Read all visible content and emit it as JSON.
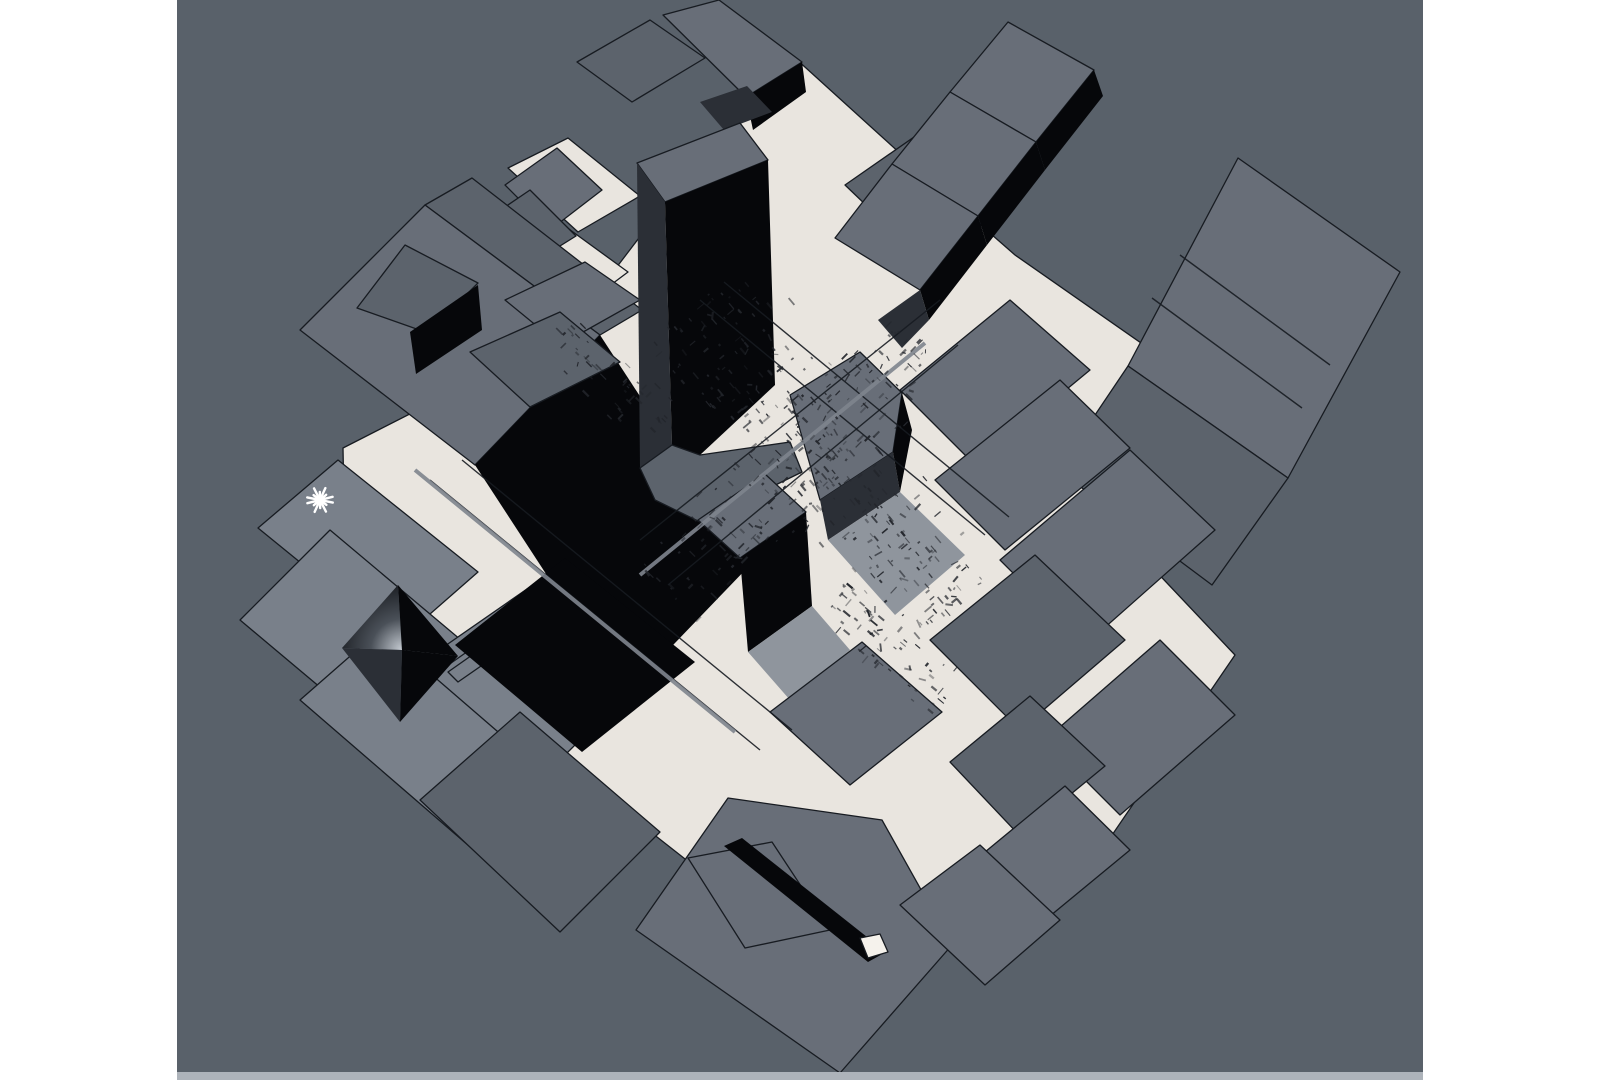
{
  "meta": {
    "description": "Aerial axonometric 3D massing model of a dense city district (Times Square style) shown in a render viewport",
    "view": "perspective top-down, model rotated ~40 degrees",
    "visible_text": "none"
  },
  "canvas": {
    "width": 1599,
    "height": 1080,
    "margin_color": "#ffffff"
  },
  "viewport": {
    "x": 177,
    "y": 0,
    "width": 1246,
    "height": 1080,
    "background": "#59616a",
    "bottom_strip": {
      "x": 177,
      "y": 1072,
      "width": 1246,
      "height": 8,
      "color": "#adb3ba"
    }
  },
  "palette": {
    "bg": "#59616a",
    "roof": "#686e78",
    "roofL": "#79808a",
    "roofD": "#5c636c",
    "side": "#06070a",
    "side2": "#2b2f36",
    "cream": "#e9e5df",
    "creamB": "#f5f2ec",
    "line": "#171b21",
    "shadow": "#8f959d",
    "bar": "#7f858e",
    "noise": "#23262c",
    "marker": "#ffffff"
  },
  "marker": {
    "shape": "asterisk-light-marker",
    "x": 320,
    "y": 500,
    "size": 13,
    "spikes": 7,
    "color": "#ffffff"
  },
  "scene": {
    "gradients": [
      {
        "id": "pyrGrad",
        "type": "radial",
        "cx": 402,
        "cy": 650,
        "r": 78,
        "stops": [
          [
            "0",
            "#c6ccd3"
          ],
          [
            "0.4",
            "#4a5058"
          ],
          [
            "1",
            "#0b0d11"
          ]
        ]
      }
    ],
    "polygons": [
      {
        "name": "ground-plaza",
        "fill": "cream",
        "stroke": "line",
        "points": "795,58 935,185 1015,255 1290,447 1150,565 1235,655 1095,860 995,965 890,880 820,965 610,800 505,690 345,555 343,448 565,335 645,230 705,150"
      },
      {
        "name": "ground-patch-topleft",
        "fill": "cream",
        "stroke": "line",
        "points": "508,168 568,138 640,196 578,232"
      },
      {
        "name": "ground-patch-left",
        "fill": "cream",
        "stroke": "line",
        "points": "515,258 562,224 628,272 580,308"
      },
      {
        "name": "building-far-right-roof",
        "fill": "roof",
        "stroke": "line",
        "points": "1238,158 1400,272 1288,478 1128,366"
      },
      {
        "name": "building-far-right-terrace",
        "fill": "roofD",
        "stroke": "line",
        "points": "1128,366 1288,478 1212,585 1058,470"
      },
      {
        "name": "building-topright-block",
        "fill": "roofD",
        "stroke": "line",
        "points": "845,185 950,112 1020,176 915,252"
      },
      {
        "name": "ziggurat-tier1-roof",
        "fill": "roof",
        "stroke": "line",
        "points": "1008,22 1094,70 1036,142 950,92"
      },
      {
        "name": "ziggurat-tier1-shade",
        "fill": "side",
        "stroke": "none",
        "points": "1094,70 1103,96 1045,170 1036,142"
      },
      {
        "name": "ziggurat-tier2-roof",
        "fill": "roof",
        "stroke": "line",
        "points": "950,92 1036,142 978,216 892,164"
      },
      {
        "name": "ziggurat-tier2-shade",
        "fill": "side",
        "stroke": "none",
        "points": "1036,142 1045,170 987,245 978,216"
      },
      {
        "name": "ziggurat-tier3-roof",
        "fill": "roof",
        "stroke": "line",
        "points": "892,164 978,216 920,290 835,238"
      },
      {
        "name": "ziggurat-tier3-shade",
        "fill": "side",
        "stroke": "none",
        "points": "978,216 987,245 929,320 920,290"
      },
      {
        "name": "ziggurat-base-shade",
        "fill": "side2",
        "stroke": "none",
        "points": "920,290 929,320 902,348 878,320"
      },
      {
        "name": "topcluster-bar-roof",
        "fill": "roofD",
        "stroke": "line",
        "points": "577,62 650,20 705,58 632,102"
      },
      {
        "name": "topcluster-box-roof",
        "fill": "roof",
        "stroke": "line",
        "points": "663,15 719,0 802,62 746,97"
      },
      {
        "name": "topcluster-box-side",
        "fill": "side",
        "stroke": "none",
        "points": "746,97 802,62 806,92 753,130"
      },
      {
        "name": "topcluster-shadow",
        "fill": "side2",
        "stroke": "none",
        "points": "700,102 747,86 772,112 724,130"
      },
      {
        "name": "topleft-small-roof-1",
        "fill": "roof",
        "stroke": "line",
        "points": "505,185 557,148 602,190 550,230"
      },
      {
        "name": "topleft-small-roof-2",
        "fill": "roofD",
        "stroke": "line",
        "points": "468,232 530,190 576,236 515,274"
      },
      {
        "name": "bigslab-terrace",
        "fill": "roofD",
        "stroke": "line",
        "points": "425,205 472,178 642,310 600,335"
      },
      {
        "name": "bigslab-roof",
        "fill": "roof",
        "stroke": "line",
        "points": "300,330 425,205 600,335 475,465"
      },
      {
        "name": "bigslab-penthouse-roof",
        "fill": "roofD",
        "stroke": "line",
        "points": "405,245 478,283 428,333 357,308"
      },
      {
        "name": "bigslab-penthouse-side",
        "fill": "side",
        "stroke": "none",
        "points": "410,332 478,285 482,330 416,374"
      },
      {
        "name": "bigslab-black-face",
        "fill": "side",
        "stroke": "none",
        "points": "475,465 600,335 750,565 625,695"
      },
      {
        "name": "midleft-block-1",
        "fill": "roof",
        "stroke": "line",
        "points": "505,300 585,262 640,300 560,345"
      },
      {
        "name": "midleft-block-2",
        "fill": "roofD",
        "stroke": "line",
        "points": "470,352 560,312 620,362 530,407"
      },
      {
        "name": "tower-roof",
        "fill": "roof",
        "stroke": "line",
        "points": "637,163 740,123 768,160 665,202"
      },
      {
        "name": "tower-west-face",
        "fill": "side2",
        "stroke": "none",
        "points": "637,163 665,202 672,445 640,468"
      },
      {
        "name": "tower-front-face",
        "fill": "side",
        "stroke": "none",
        "points": "665,202 768,160 775,385 700,455 672,445"
      },
      {
        "name": "tower-base-podium",
        "fill": "roofD",
        "stroke": "line",
        "points": "640,468 672,445 700,455 790,442 802,472 700,522 655,500"
      },
      {
        "name": "district-block-0",
        "fill": "roof",
        "stroke": "line",
        "points": "900,390 1010,300 1090,370 975,465"
      },
      {
        "name": "district-block-1",
        "fill": "roof",
        "stroke": "line",
        "points": "935,480 1060,380 1130,448 1005,550"
      },
      {
        "name": "district-block-2",
        "fill": "roof",
        "stroke": "line",
        "points": "1000,560 1130,450 1215,530 1085,645"
      },
      {
        "name": "district-block-3",
        "fill": "roofD",
        "stroke": "line",
        "points": "930,640 1035,555 1125,640 1020,730"
      },
      {
        "name": "district-block-4",
        "fill": "roof",
        "stroke": "line",
        "points": "1045,740 1160,640 1235,715 1120,815"
      },
      {
        "name": "district-block-5",
        "fill": "roofD",
        "stroke": "line",
        "points": "950,762 1030,696 1105,766 1020,836"
      },
      {
        "name": "district-block-6",
        "fill": "roof",
        "stroke": "line",
        "points": "985,852 1065,786 1130,850 1050,916"
      },
      {
        "name": "center-tower-roof",
        "fill": "roof",
        "stroke": "line",
        "points": "790,395 860,352 902,393 893,452 820,500"
      },
      {
        "name": "center-tower-side",
        "fill": "side2",
        "stroke": "none",
        "points": "820,500 893,452 900,492 828,540"
      },
      {
        "name": "center-tower-dark-side",
        "fill": "side",
        "stroke": "none",
        "points": "893,452 902,393 912,430 900,492"
      },
      {
        "name": "center-tower-shadow",
        "fill": "shadow",
        "stroke": "none",
        "points": "828,540 900,492 965,555 895,615"
      },
      {
        "name": "small-tower-roof",
        "fill": "roof",
        "stroke": "line",
        "points": "698,520 765,474 806,512 740,558"
      },
      {
        "name": "small-tower-side",
        "fill": "side",
        "stroke": "none",
        "points": "740,558 806,512 812,606 748,652"
      },
      {
        "name": "small-tower-shadow",
        "fill": "shadow",
        "stroke": "none",
        "points": "748,652 812,606 850,650 790,700"
      },
      {
        "name": "center-bottom-block",
        "fill": "roof",
        "stroke": "line",
        "points": "770,712 862,642 942,712 850,785"
      },
      {
        "name": "marker-slab-a",
        "fill": "roofL",
        "stroke": "line",
        "points": "258,528 338,460 478,572 398,642"
      },
      {
        "name": "marker-slab-b",
        "fill": "roofL",
        "stroke": "line",
        "points": "240,620 330,530 580,740 490,830"
      },
      {
        "name": "marker-slab-c",
        "fill": "roofL",
        "stroke": "line",
        "points": "300,700 380,630 600,820 520,890"
      },
      {
        "name": "marker-slab-d",
        "fill": "roofD",
        "stroke": "line",
        "points": "420,800 520,712 660,832 560,932"
      },
      {
        "name": "pyramid-bar-1",
        "fill": "roofL",
        "stroke": "line",
        "points": "432,655 540,580 552,592 444,668"
      },
      {
        "name": "pyramid-bar-2",
        "fill": "roofL",
        "stroke": "line",
        "points": "448,672 556,596 566,607 458,682"
      },
      {
        "name": "black-box",
        "fill": "side",
        "stroke": "none",
        "points": "455,645 565,558 695,662 582,752"
      },
      {
        "name": "pyramid-face-nw",
        "fill": "pyrGrad",
        "stroke": "none",
        "points": "342,648 398,585 402,650"
      },
      {
        "name": "pyramid-face-ne",
        "fill": "side",
        "stroke": "none",
        "points": "398,585 458,656 402,650"
      },
      {
        "name": "pyramid-face-sw",
        "fill": "side2",
        "stroke": "none",
        "points": "342,648 400,722 402,650"
      },
      {
        "name": "pyramid-face-se",
        "fill": "side",
        "stroke": "none",
        "points": "458,656 400,722 402,650"
      },
      {
        "name": "bottom-slab-roof",
        "fill": "roof",
        "stroke": "line",
        "points": "636,930 728,798 882,820 952,945 840,1073"
      },
      {
        "name": "bottom-slab-inner",
        "fill": "none",
        "stroke": "line",
        "points": "688,858 772,842 830,930 745,948"
      },
      {
        "name": "bottom-slab-slot",
        "fill": "side",
        "stroke": "none",
        "points": "724,846 742,838 886,952 868,962"
      },
      {
        "name": "bottom-slab-white-patch",
        "fill": "creamB",
        "stroke": "line",
        "points": "860,938 880,934 888,952 868,958"
      },
      {
        "name": "bottom-slab-extension",
        "fill": "roof",
        "stroke": "line",
        "points": "900,905 980,845 1060,920 985,985"
      }
    ],
    "lines": [
      {
        "name": "street-line-1",
        "x1": 640,
        "y1": 540,
        "x2": 940,
        "y2": 300,
        "w": 1.4,
        "color": "line"
      },
      {
        "name": "street-line-2",
        "x1": 668,
        "y1": 585,
        "x2": 958,
        "y2": 345,
        "w": 1.4,
        "color": "line"
      },
      {
        "name": "street-line-3",
        "x1": 430,
        "y1": 480,
        "x2": 760,
        "y2": 750,
        "w": 1.4,
        "color": "line"
      },
      {
        "name": "street-line-4",
        "x1": 462,
        "y1": 460,
        "x2": 792,
        "y2": 730,
        "w": 1.4,
        "color": "line"
      },
      {
        "name": "street-line-5",
        "x1": 700,
        "y1": 300,
        "x2": 985,
        "y2": 535,
        "w": 1.4,
        "color": "line"
      },
      {
        "name": "street-line-6",
        "x1": 724,
        "y1": 282,
        "x2": 1009,
        "y2": 517,
        "w": 1.4,
        "color": "line"
      },
      {
        "name": "median-bar-1",
        "x1": 415,
        "y1": 470,
        "x2": 735,
        "y2": 732,
        "w": 4,
        "color": "bar"
      },
      {
        "name": "median-bar-2",
        "x1": 640,
        "y1": 575,
        "x2": 925,
        "y2": 343,
        "w": 4,
        "color": "bar"
      },
      {
        "name": "slab-panel-line-1",
        "x1": 1180,
        "y1": 255,
        "x2": 1330,
        "y2": 365,
        "w": 1.4,
        "color": "line"
      },
      {
        "name": "slab-panel-line-2",
        "x1": 1152,
        "y1": 298,
        "x2": 1302,
        "y2": 408,
        "w": 1.4,
        "color": "line"
      }
    ],
    "noise": {
      "seed": 1337,
      "color": "#23262c",
      "bands": [
        {
          "x1": 690,
          "y1": 310,
          "x2": 945,
          "y2": 615,
          "hw": 90,
          "n": 300
        },
        {
          "x1": 920,
          "y1": 340,
          "x2": 665,
          "y2": 600,
          "hw": 65,
          "n": 170
        },
        {
          "x1": 560,
          "y1": 330,
          "x2": 660,
          "y2": 430,
          "hw": 40,
          "n": 50
        },
        {
          "x1": 830,
          "y1": 600,
          "x2": 950,
          "y2": 700,
          "hw": 45,
          "n": 60
        }
      ]
    }
  }
}
